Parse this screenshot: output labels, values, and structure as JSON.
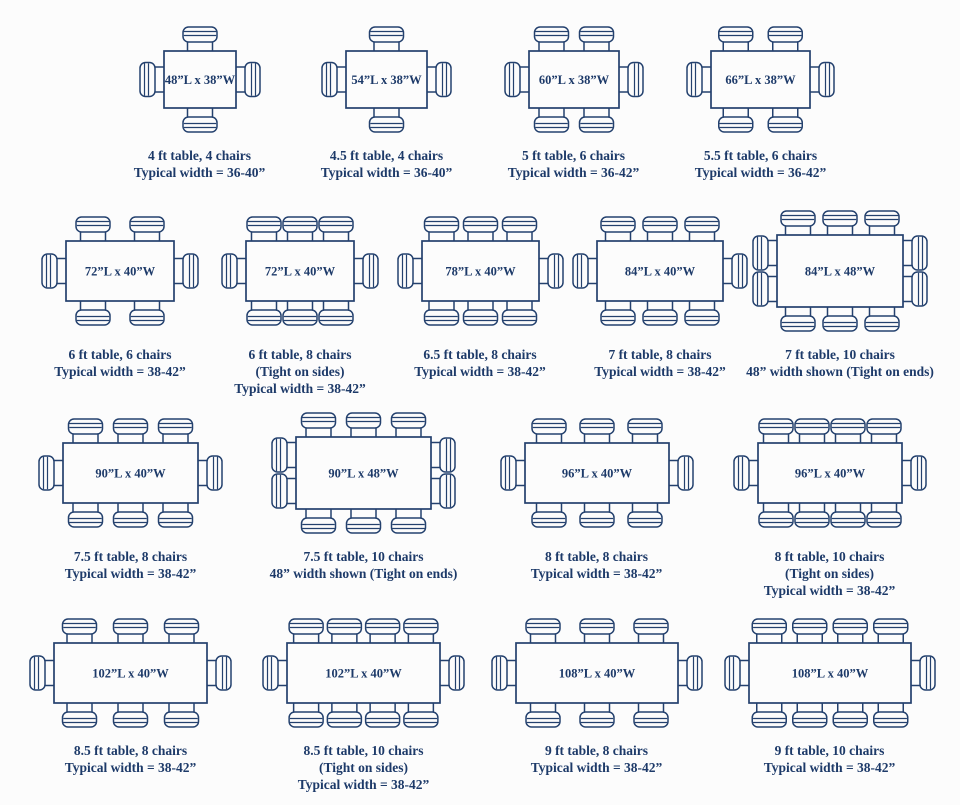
{
  "page": {
    "background": "#fcfcfc",
    "ink_color": "#24416e",
    "text_color": "#1d3a69"
  },
  "diagram": {
    "scale_px_per_inch": 1.5,
    "rows": [
      {
        "cells": [
          {
            "size_label": "48”L x 38”W",
            "length_in": 48,
            "width_in": 38,
            "chairs": {
              "top": 1,
              "bottom": 1,
              "left": 1,
              "right": 1
            },
            "caption_lines": [
              "4 ft table, 4 chairs",
              "Typical width = 36-40”"
            ]
          },
          {
            "size_label": "54”L x 38”W",
            "length_in": 54,
            "width_in": 38,
            "chairs": {
              "top": 1,
              "bottom": 1,
              "left": 1,
              "right": 1
            },
            "caption_lines": [
              "4.5 ft table, 4 chairs",
              "Typical width = 36-40”"
            ]
          },
          {
            "size_label": "60”L x 38”W",
            "length_in": 60,
            "width_in": 38,
            "chairs": {
              "top": 2,
              "bottom": 2,
              "left": 1,
              "right": 1
            },
            "caption_lines": [
              "5 ft table, 6 chairs",
              "Typical width = 36-42”"
            ]
          },
          {
            "size_label": "66”L x 38”W",
            "length_in": 66,
            "width_in": 38,
            "chairs": {
              "top": 2,
              "bottom": 2,
              "left": 1,
              "right": 1
            },
            "caption_lines": [
              "5.5 ft table, 6 chairs",
              "Typical width = 36-42”"
            ]
          }
        ]
      },
      {
        "cells": [
          {
            "size_label": "72”L x 40”W",
            "length_in": 72,
            "width_in": 40,
            "chairs": {
              "top": 2,
              "bottom": 2,
              "left": 1,
              "right": 1
            },
            "caption_lines": [
              "6 ft table, 6 chairs",
              "Typical width = 38-42”"
            ]
          },
          {
            "size_label": "72”L x 40”W",
            "length_in": 72,
            "width_in": 40,
            "chairs": {
              "top": 3,
              "bottom": 3,
              "left": 1,
              "right": 1
            },
            "caption_lines": [
              "6 ft table, 8 chairs",
              "(Tight on sides)",
              "Typical width = 38-42”"
            ]
          },
          {
            "size_label": "78”L x 40”W",
            "length_in": 78,
            "width_in": 40,
            "chairs": {
              "top": 3,
              "bottom": 3,
              "left": 1,
              "right": 1
            },
            "caption_lines": [
              "6.5 ft table, 8 chairs",
              "Typical width = 38-42”"
            ]
          },
          {
            "size_label": "84”L x 40”W",
            "length_in": 84,
            "width_in": 40,
            "chairs": {
              "top": 3,
              "bottom": 3,
              "left": 1,
              "right": 1
            },
            "caption_lines": [
              "7 ft table, 8 chairs",
              "Typical width = 38-42”"
            ]
          },
          {
            "size_label": "84”L x 48”W",
            "length_in": 84,
            "width_in": 48,
            "chairs": {
              "top": 3,
              "bottom": 3,
              "left": 2,
              "right": 2
            },
            "caption_lines": [
              "7 ft table, 10 chairs",
              "48” width shown (Tight on ends)"
            ]
          }
        ]
      },
      {
        "cells": [
          {
            "size_label": "90”L x 40”W",
            "length_in": 90,
            "width_in": 40,
            "chairs": {
              "top": 3,
              "bottom": 3,
              "left": 1,
              "right": 1
            },
            "caption_lines": [
              "7.5 ft table, 8 chairs",
              "Typical width = 38-42”"
            ]
          },
          {
            "size_label": "90”L x 48”W",
            "length_in": 90,
            "width_in": 48,
            "chairs": {
              "top": 3,
              "bottom": 3,
              "left": 2,
              "right": 2
            },
            "caption_lines": [
              "7.5 ft table, 10 chairs",
              "48” width shown (Tight on ends)"
            ]
          },
          {
            "size_label": "96”L x 40”W",
            "length_in": 96,
            "width_in": 40,
            "chairs": {
              "top": 3,
              "bottom": 3,
              "left": 1,
              "right": 1
            },
            "caption_lines": [
              "8 ft table, 8 chairs",
              "Typical width = 38-42”"
            ]
          },
          {
            "size_label": "96”L x 40”W",
            "length_in": 96,
            "width_in": 40,
            "chairs": {
              "top": 4,
              "bottom": 4,
              "left": 1,
              "right": 1
            },
            "caption_lines": [
              "8 ft table, 10 chairs",
              "(Tight on sides)",
              "Typical width = 38-42”"
            ]
          }
        ]
      },
      {
        "cells": [
          {
            "size_label": "102”L x 40”W",
            "length_in": 102,
            "width_in": 40,
            "chairs": {
              "top": 3,
              "bottom": 3,
              "left": 1,
              "right": 1
            },
            "caption_lines": [
              "8.5 ft table, 8 chairs",
              "Typical width = 38-42”"
            ]
          },
          {
            "size_label": "102”L x 40”W",
            "length_in": 102,
            "width_in": 40,
            "chairs": {
              "top": 4,
              "bottom": 4,
              "left": 1,
              "right": 1
            },
            "caption_lines": [
              "8.5 ft table, 10 chairs",
              "(Tight on sides)",
              "Typical width = 38-42”"
            ]
          },
          {
            "size_label": "108”L x 40”W",
            "length_in": 108,
            "width_in": 40,
            "chairs": {
              "top": 3,
              "bottom": 3,
              "left": 1,
              "right": 1
            },
            "caption_lines": [
              "9 ft table, 8 chairs",
              "Typical width = 38-42”"
            ]
          },
          {
            "size_label": "108”L x 40”W",
            "length_in": 108,
            "width_in": 40,
            "chairs": {
              "top": 4,
              "bottom": 4,
              "left": 1,
              "right": 1
            },
            "caption_lines": [
              "9 ft table, 10 chairs",
              "Typical width = 38-42”"
            ]
          }
        ]
      }
    ]
  }
}
